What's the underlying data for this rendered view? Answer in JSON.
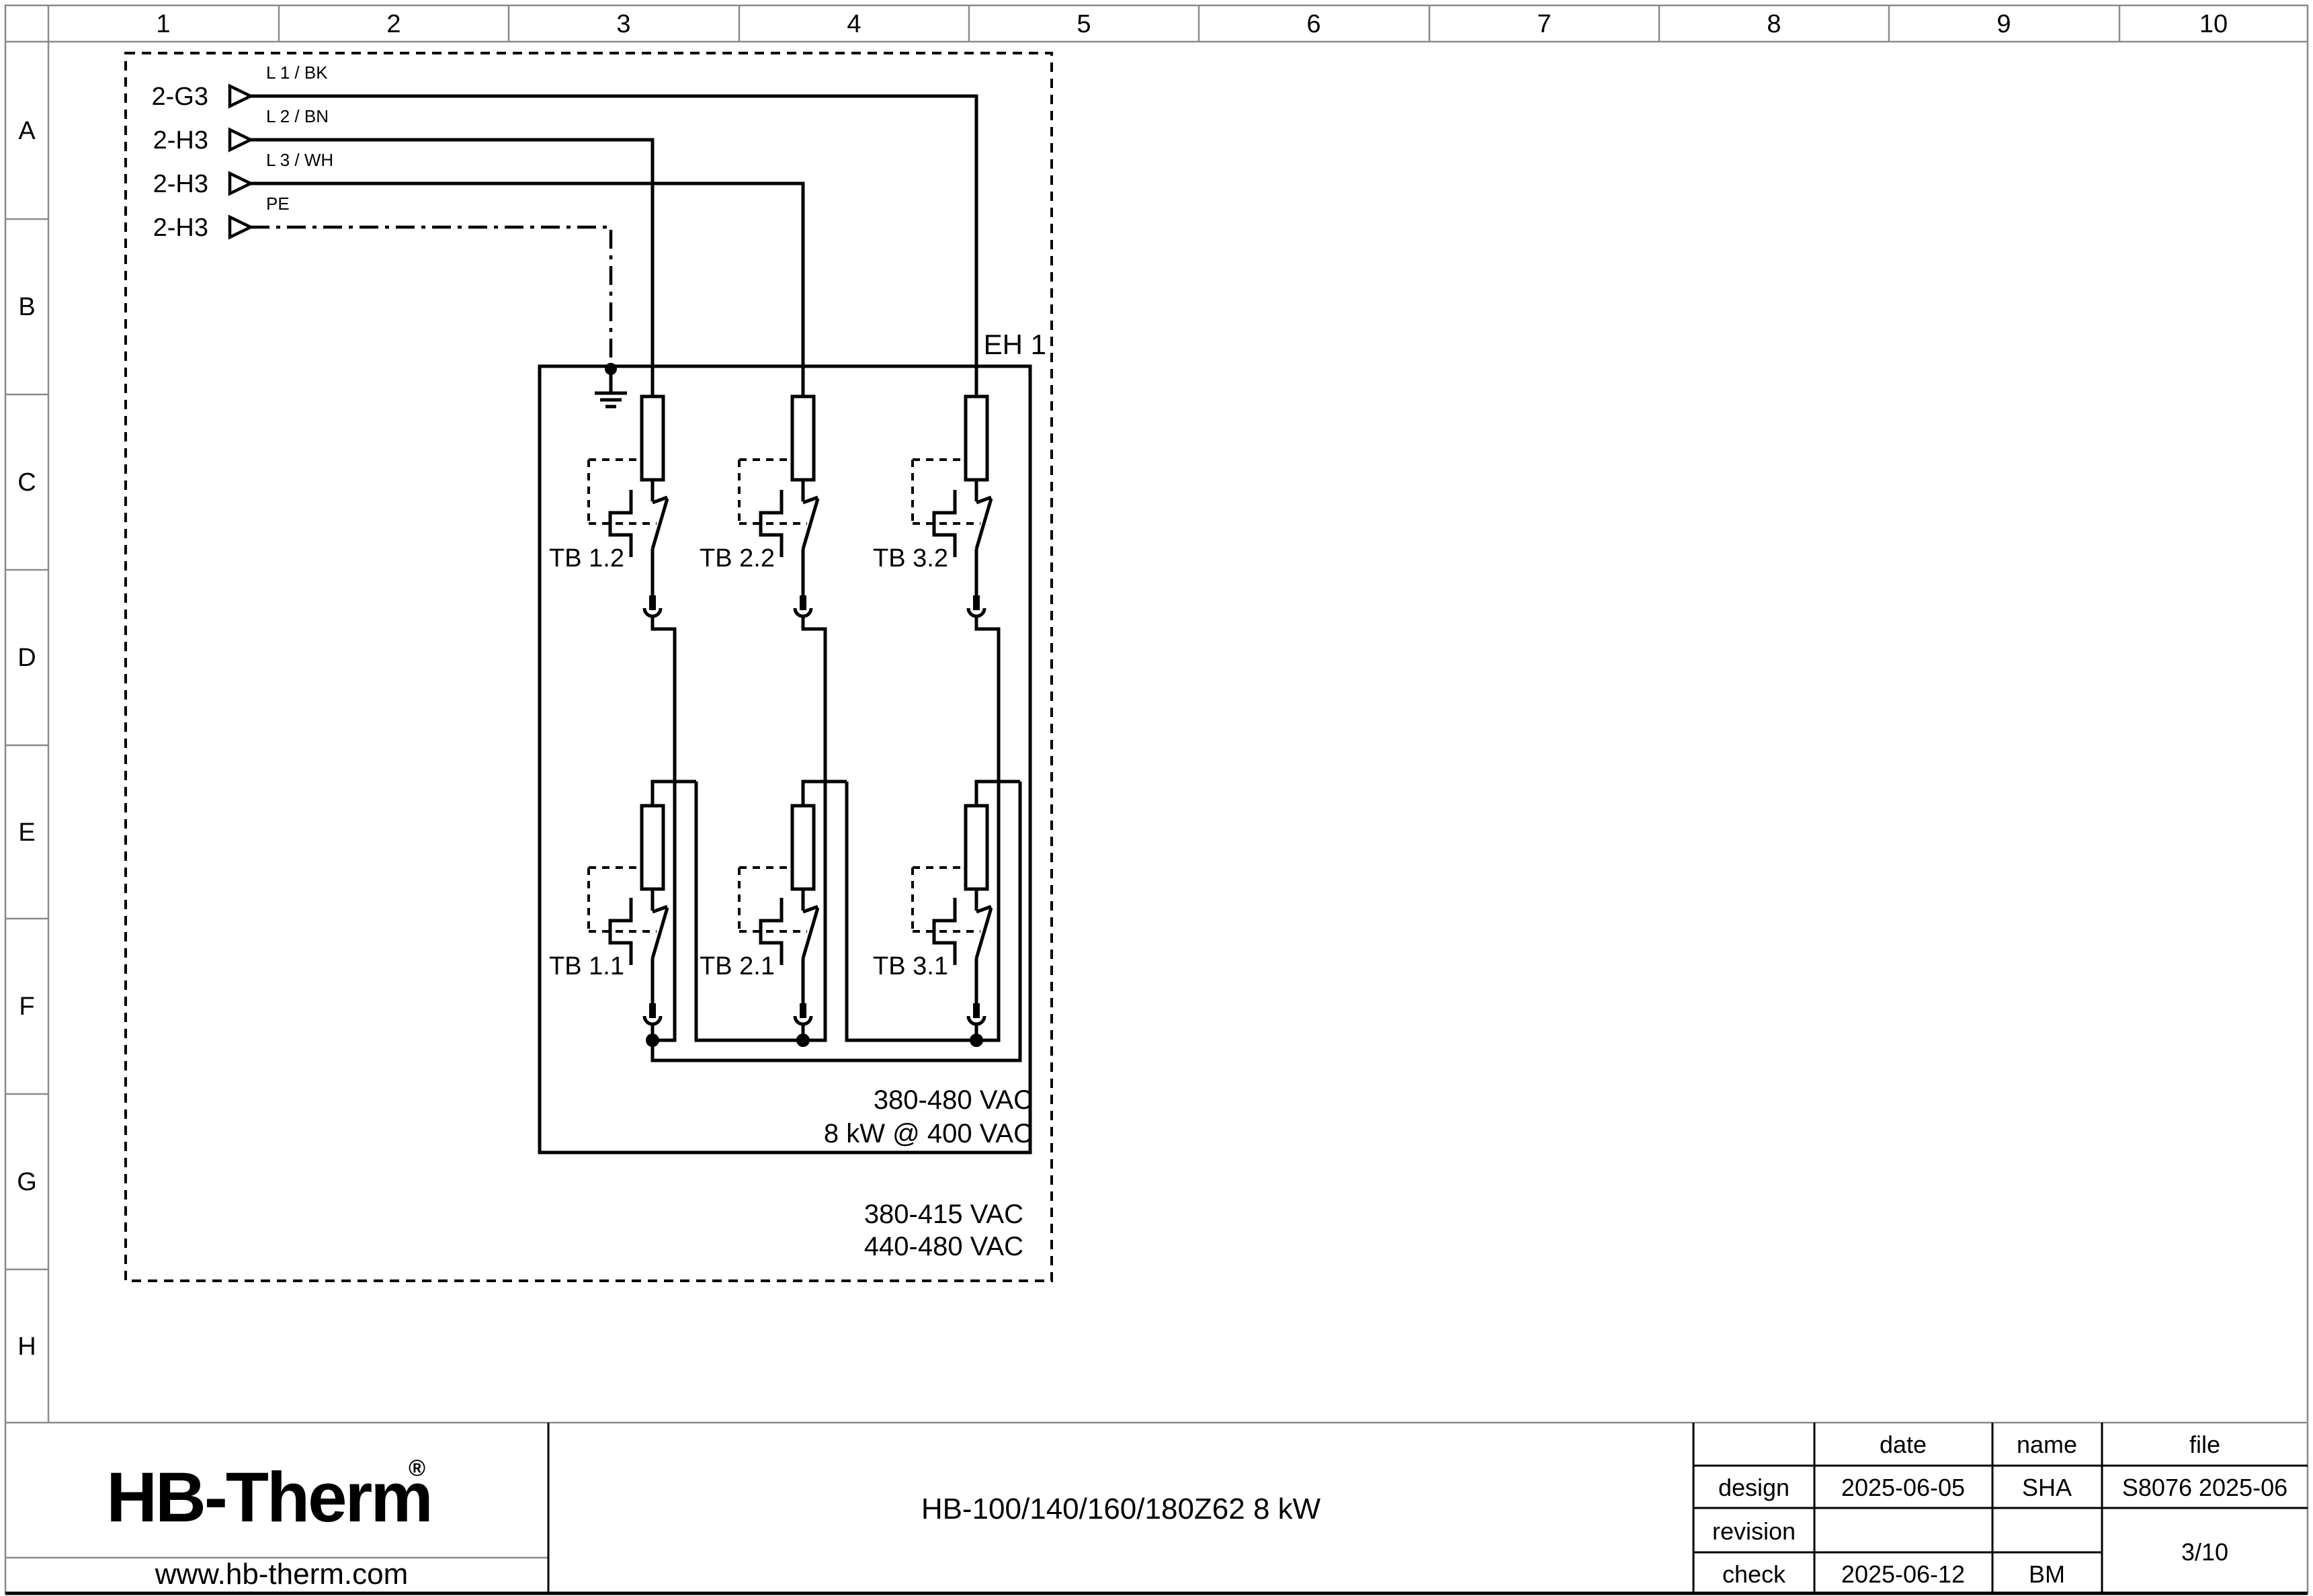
{
  "ruler": {
    "columns": [
      "1",
      "2",
      "3",
      "4",
      "5",
      "6",
      "7",
      "8",
      "9",
      "10"
    ],
    "rows": [
      "A",
      "B",
      "C",
      "D",
      "E",
      "F",
      "G",
      "H"
    ]
  },
  "schematic": {
    "eh_label": "EH 1",
    "feeds": [
      {
        "ref": "2-G3",
        "wire_label": "L 1 / BK"
      },
      {
        "ref": "2-H3",
        "wire_label": "L 2 / BN"
      },
      {
        "ref": "2-H3",
        "wire_label": "L 3 / WH"
      },
      {
        "ref": "2-H3",
        "wire_label": "PE"
      }
    ],
    "thermal_breakers_upper": [
      "TB 1.2",
      "TB 2.2",
      "TB 3.2"
    ],
    "thermal_breakers_lower": [
      "TB 1.1",
      "TB 2.1",
      "TB 3.1"
    ],
    "rating": [
      "380-480 VAC",
      "8 kW @ 400 VAC"
    ],
    "voltage_ranges": [
      "380-415 VAC",
      "440-480 VAC"
    ]
  },
  "title_block": {
    "logo_text": "HB-Therm",
    "logo_reg": "®",
    "website": "www.hb-therm.com",
    "doc_title": "HB-100/140/160/180Z62 8 kW",
    "table": {
      "headers": [
        "date",
        "name",
        "file"
      ],
      "row_labels": [
        "design",
        "revision",
        "check"
      ],
      "design": {
        "date": "2025-06-05",
        "name": "SHA",
        "file": "S8076 2025-06"
      },
      "check": {
        "date": "2025-06-12",
        "name": "BM"
      },
      "page": "3/10"
    }
  },
  "colors": {
    "logo_navy": "#1b2a4a",
    "frame_gray": "#8a8a8a",
    "ink": "#000000"
  }
}
